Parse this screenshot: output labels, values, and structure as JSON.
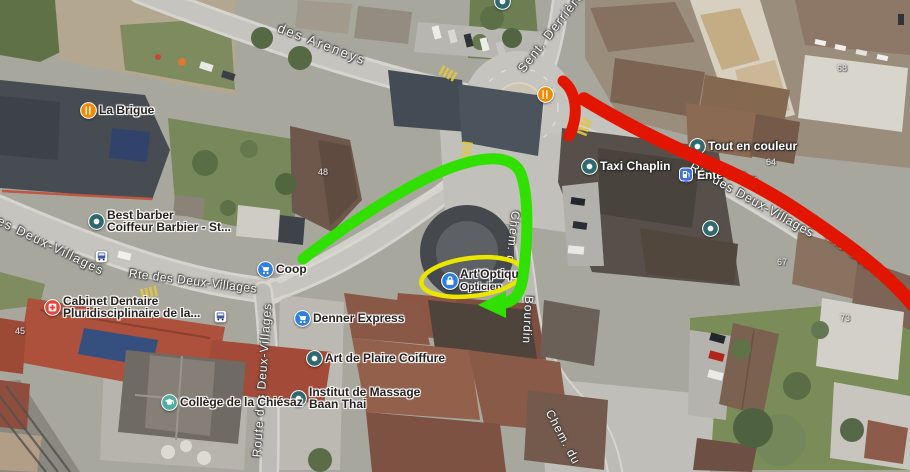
{
  "map": {
    "street_labels": [
      {
        "id": "areneys",
        "text": "des Areneys",
        "x": 322,
        "y": 44,
        "rot": 21,
        "size": 13,
        "ls": 2
      },
      {
        "id": "sent-derriere",
        "text": "Sent. Derrière",
        "x": 551,
        "y": 32,
        "rot": -52,
        "size": 12.5,
        "ls": 1.5
      },
      {
        "id": "deux-villages-left",
        "text": "des Deux-Villages",
        "x": 47,
        "y": 244,
        "rot": 26,
        "size": 12.5,
        "ls": 1.5
      },
      {
        "id": "rte-deux-vill-center",
        "text": "Rte des Deux-Villages",
        "x": 193,
        "y": 281,
        "rot": 7,
        "size": 12,
        "ls": 0.5
      },
      {
        "id": "route-deux-villages-vertical",
        "text": "Route des Deux-Villages",
        "x": 262,
        "y": 380,
        "rot": -86,
        "size": 12,
        "ls": 1
      },
      {
        "id": "chem-bourdin-upper",
        "text": "Chem. d",
        "x": 513,
        "y": 237,
        "rot": 96,
        "size": 12,
        "ls": 1
      },
      {
        "id": "chem-bourdin-lower",
        "text": "Bourdin",
        "x": 528,
        "y": 320,
        "rot": 93,
        "size": 12,
        "ls": 1
      },
      {
        "id": "rte-deux-villages-east",
        "text": "Rte des Deux-Villages",
        "x": 752,
        "y": 200,
        "rot": 29,
        "size": 12.5,
        "ls": 0.8
      },
      {
        "id": "rte-deux-east2",
        "text": "Rte des Deux",
        "x": 866,
        "y": 262,
        "rot": 36,
        "size": 13,
        "ls": 1.5
      },
      {
        "id": "chem-du",
        "text": "Chem. du",
        "x": 563,
        "y": 437,
        "rot": 62,
        "size": 12,
        "ls": 1
      }
    ],
    "house_numbers": [
      {
        "text": "45",
        "x": 20,
        "y": 331
      },
      {
        "text": "48",
        "x": 323,
        "y": 172
      },
      {
        "text": "68",
        "x": 842,
        "y": 68
      },
      {
        "text": "64",
        "x": 771,
        "y": 162
      },
      {
        "text": "67",
        "x": 782,
        "y": 262
      },
      {
        "text": "73",
        "x": 845,
        "y": 318
      }
    ],
    "pois": [
      {
        "id": "pizza-kebab",
        "icon": "restaurant",
        "color": "#ef8a02",
        "x": 545,
        "y": 94,
        "side": "left",
        "light": false,
        "lines": [
          "PIZZA-Kebab-St-Légier-Tasty",
          "Crispy"
        ]
      },
      {
        "id": "la-brigue",
        "icon": "restaurant",
        "color": "#ef8a02",
        "x": 88,
        "y": 110,
        "side": "right",
        "light": false,
        "lines": [
          "La Brigue"
        ]
      },
      {
        "id": "best-barber",
        "icon": "dot",
        "color": "#2f686e",
        "x": 96,
        "y": 221,
        "side": "right",
        "light": false,
        "lines": [
          "Best barber",
          "Coiffeur Barbier -  St..."
        ]
      },
      {
        "id": "cabinet-dentaire",
        "icon": "medical",
        "color": "#e8463a",
        "x": 52,
        "y": 307,
        "side": "right",
        "light": false,
        "lines": [
          "Cabinet Dentaire",
          "Pluridisciplinaire de la..."
        ]
      },
      {
        "id": "coop",
        "icon": "cart",
        "color": "#2e7de1",
        "x": 265,
        "y": 269,
        "side": "right",
        "light": false,
        "lines": [
          "Coop"
        ]
      },
      {
        "id": "denner-express",
        "icon": "cart",
        "color": "#2e7de1",
        "x": 302,
        "y": 318,
        "side": "right",
        "light": false,
        "lines": [
          "Denner Express"
        ]
      },
      {
        "id": "art-de-plaire",
        "icon": "dot",
        "color": "#2f686e",
        "x": 314,
        "y": 358,
        "side": "right",
        "light": false,
        "lines": [
          "Art de Plaire Coiffure"
        ]
      },
      {
        "id": "institut-massage",
        "icon": "dot",
        "color": "#2f686e",
        "x": 298,
        "y": 398,
        "side": "right",
        "light": false,
        "lines": [
          "Institut de Massage",
          "Baan Thai"
        ]
      },
      {
        "id": "college-chiesaz",
        "icon": "school",
        "color": "#4fae9f",
        "x": 169,
        "y": 402,
        "side": "right",
        "light": false,
        "lines": [
          "Collège de la Chiésaz"
        ]
      },
      {
        "id": "art-optique",
        "icon": "optique",
        "color": "#2e7de1",
        "x": 449,
        "y": 280,
        "side": "right",
        "light": false,
        "lines": [
          "Art'Optique"
        ],
        "sub": "Opticien"
      },
      {
        "id": "taxi-chaplin",
        "icon": "dot",
        "color": "#2f686e",
        "x": 589,
        "y": 166,
        "side": "right",
        "light": true,
        "lines": [
          "Taxi Chaplin"
        ]
      },
      {
        "id": "ente-des",
        "icon": "fuel",
        "color": "#3d6fe0",
        "x": 686,
        "y": 175,
        "side": "right",
        "light": true,
        "lines": [
          "Ente des..."
        ]
      },
      {
        "id": "kalin-electricite",
        "icon": "dot",
        "color": "#2f686e",
        "x": 710,
        "y": 228,
        "side": "left",
        "light": true,
        "lines": [
          "Kalin Electricité"
        ]
      },
      {
        "id": "tout-en-couleur",
        "icon": "dot",
        "color": "#2f686e",
        "x": 697,
        "y": 146,
        "side": "right",
        "light": true,
        "lines": [
          "Tout en couleur"
        ]
      },
      {
        "id": "bus-stop-west",
        "icon": "bus",
        "color": "#ffffff",
        "x": 101,
        "y": 256,
        "side": "right",
        "light": false,
        "lines": []
      },
      {
        "id": "bus-stop-center",
        "icon": "bus",
        "color": "#ffffff",
        "x": 220,
        "y": 316,
        "side": "right",
        "light": false,
        "lines": []
      },
      {
        "id": "poi-top-partial",
        "icon": "dot",
        "color": "#2f686e",
        "x": 502,
        "y": 1,
        "side": "right",
        "light": false,
        "lines": []
      }
    ],
    "annotations": {
      "red": "#E21500",
      "green": "#2FE000",
      "yellow": "#EAE600"
    }
  }
}
